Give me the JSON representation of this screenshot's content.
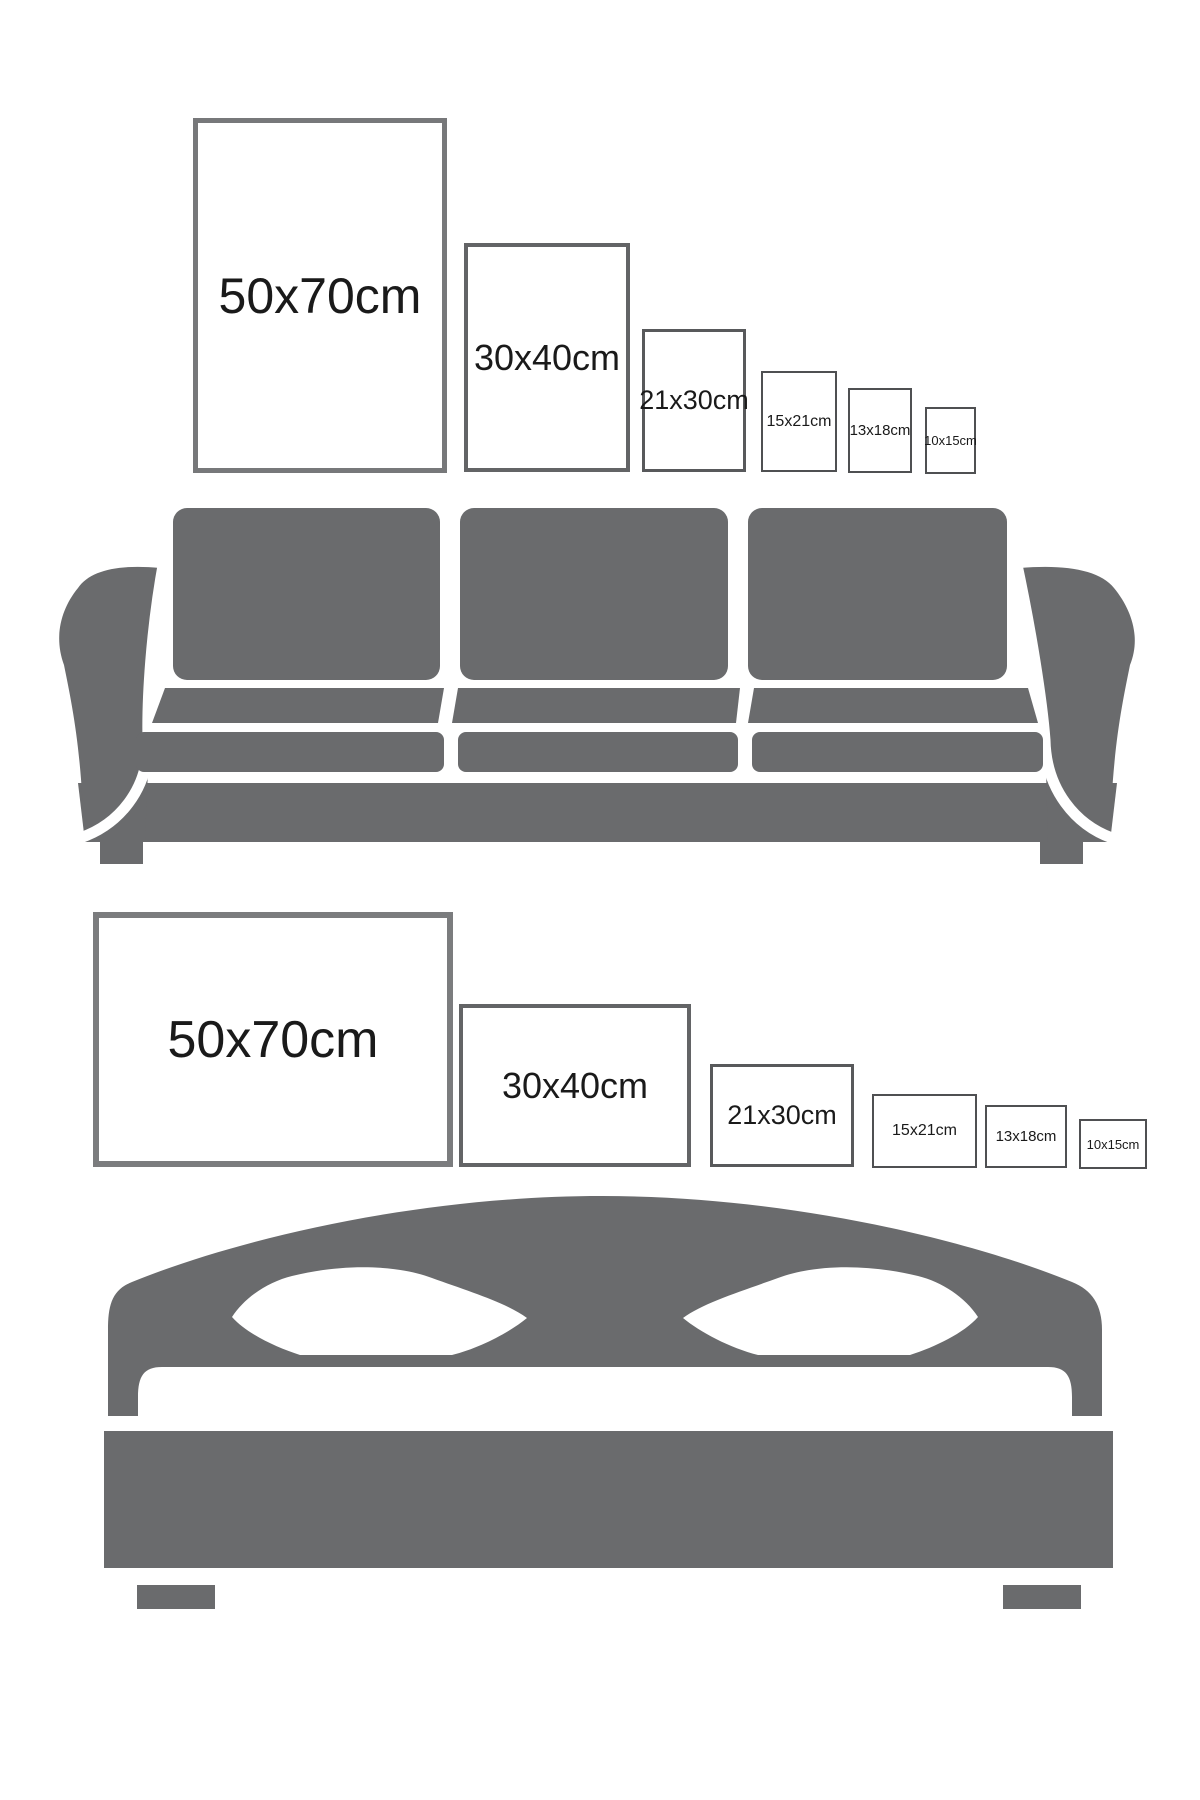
{
  "page": {
    "background": "#ffffff",
    "description": "Poster frame size comparison guide shown above a sofa (portrait orientation) and above a bed (landscape orientation)"
  },
  "colors": {
    "furniture_gray": "#6a6b6d",
    "label_text": "#1a1a1a",
    "frame_border_large": "#77787a",
    "frame_border_medium": "#636466",
    "frame_border_small": "#4f5052",
    "background": "#ffffff"
  },
  "sofa_section": {
    "furniture": "sofa",
    "frames": [
      {
        "label": "50x70cm",
        "orientation": "portrait"
      },
      {
        "label": "30x40cm",
        "orientation": "portrait"
      },
      {
        "label": "21x30cm",
        "orientation": "portrait"
      },
      {
        "label": "15x21cm",
        "orientation": "portrait"
      },
      {
        "label": "13x18cm",
        "orientation": "portrait"
      },
      {
        "label": "10x15cm",
        "orientation": "portrait"
      }
    ]
  },
  "bed_section": {
    "furniture": "bed",
    "frames": [
      {
        "label": "50x70cm",
        "orientation": "landscape"
      },
      {
        "label": "30x40cm",
        "orientation": "landscape"
      },
      {
        "label": "21x30cm",
        "orientation": "landscape"
      },
      {
        "label": "15x21cm",
        "orientation": "landscape"
      },
      {
        "label": "13x18cm",
        "orientation": "landscape"
      },
      {
        "label": "10x15cm",
        "orientation": "landscape"
      }
    ]
  }
}
